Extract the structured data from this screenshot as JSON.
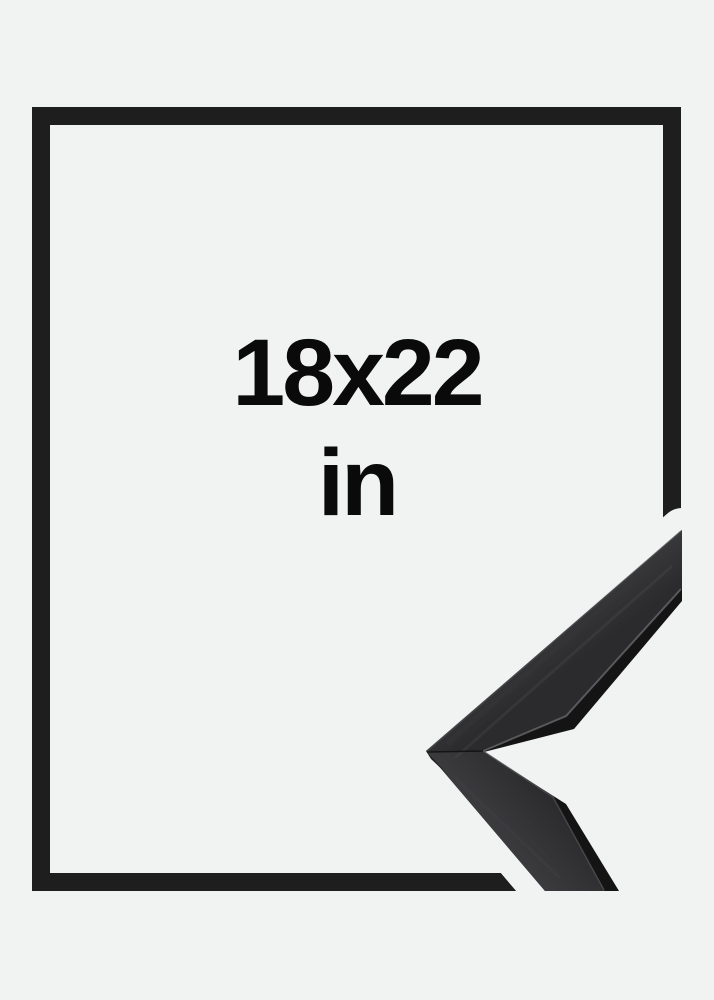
{
  "frame_preview": {
    "size_label": "18x22",
    "unit_label": "in"
  },
  "colors": {
    "bg": "#f1f2f2",
    "outline": "#1e1e1e",
    "label_text": "#0a0a0a",
    "moulding_dark_side": "#141415",
    "moulding_face_light": "#424245",
    "moulding_face_dark": "#2b2b2d",
    "moulding_arris_highlight": "#68686b"
  }
}
